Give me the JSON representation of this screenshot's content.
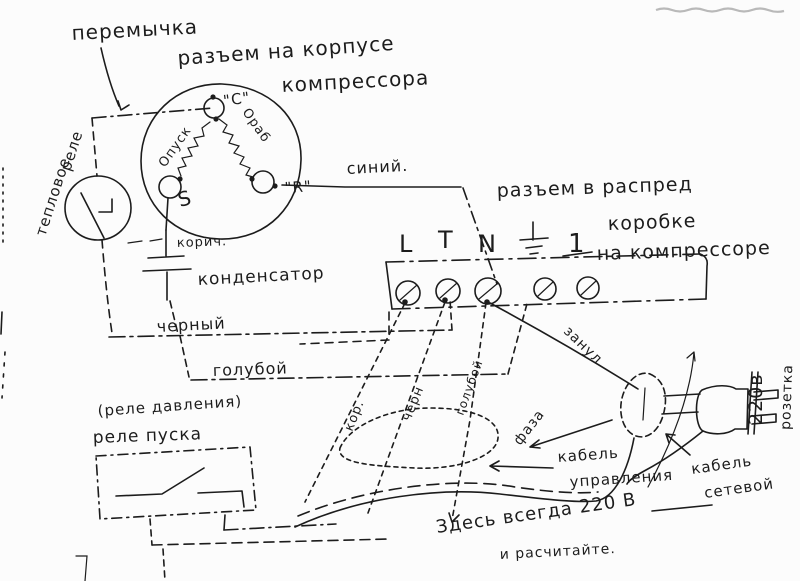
{
  "drawing": {
    "kind": "hand-drawn compressor wiring schematic (scanned page)",
    "language": "Russian",
    "ink_color": "#1c1c1c",
    "paper_color": "#fcfcfc"
  },
  "jumper_label": "перемычка",
  "motor_connector": {
    "caption_line1": "разъем на корпусе",
    "caption_line2": "компрессора",
    "terminal_c": "\"C\"",
    "terminal_s": "S",
    "terminal_r": "\"R\"",
    "winding_start": "Oпуск",
    "winding_run": "Oраб"
  },
  "thermal_relay": {
    "line1": "тепловое",
    "line2": "реле"
  },
  "capacitor_label": "конденсатор",
  "wires": {
    "blue": "синий.",
    "brown_short": "корич.",
    "black": "черный",
    "light_blue": "голубой",
    "neutral": "занул",
    "phase": "фаза"
  },
  "junction_box": {
    "caption_line1": "разъем в распред",
    "caption_line2": "коробке",
    "caption_line3": "на компрессоре",
    "terminals": {
      "l": "L",
      "t": "T",
      "n": "N",
      "one": "1"
    }
  },
  "pressure_switch": {
    "caption_line1": "(реле давления)",
    "caption_line2": "реле пуска"
  },
  "control_cable": {
    "label_line1": "кабель",
    "label_line2": "управления",
    "wire_brown": "кор.",
    "wire_black": "черн",
    "wire_blue": "голубой"
  },
  "mains": {
    "socket_line1": "220в",
    "socket_line2": "розетка",
    "cable_line1": "кабель",
    "cable_line2": "сетевой"
  },
  "note": {
    "line1": "Здесь всегда 220 В",
    "line2": "и расчитайте."
  }
}
